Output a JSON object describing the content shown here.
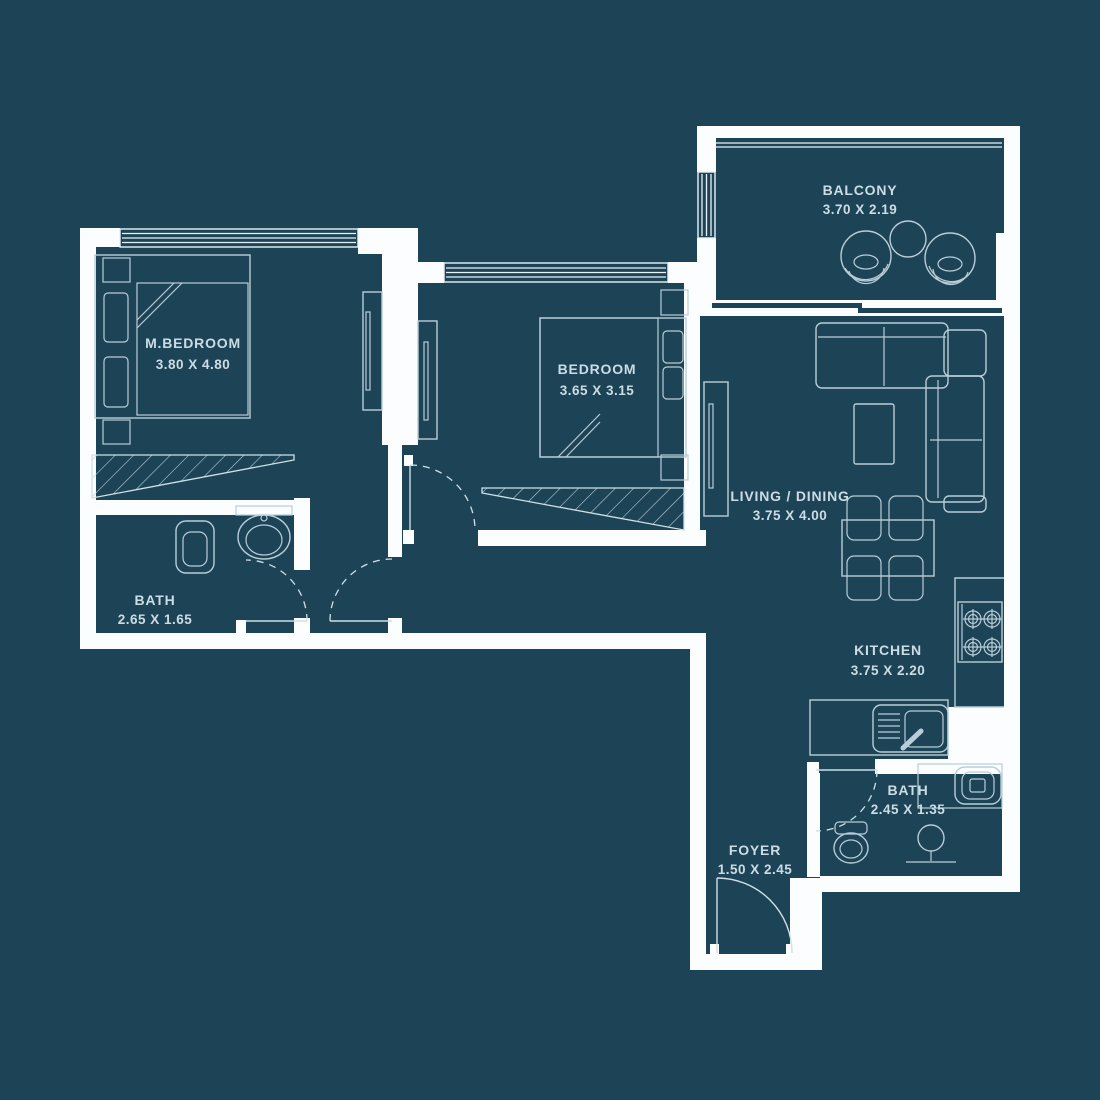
{
  "title": "apartment-floor-plan",
  "colors": {
    "background": "#1d4456",
    "wall": "#fbfdfe",
    "furniture_line": "#b9cdd8",
    "text": "#ccdce5"
  },
  "rooms": {
    "master_bedroom": {
      "name": "M.BEDROOM",
      "dims": "3.80 X 4.80"
    },
    "bedroom": {
      "name": "BEDROOM",
      "dims": "3.65 X 3.15"
    },
    "balcony": {
      "name": "BALCONY",
      "dims": "3.70 X 2.19"
    },
    "living_dining": {
      "name": "LIVING / DINING",
      "dims": "3.75 X 4.00"
    },
    "kitchen": {
      "name": "KITCHEN",
      "dims": "3.75 X 2.20"
    },
    "bath_master": {
      "name": "BATH",
      "dims": "2.65 X 1.65"
    },
    "bath_guest": {
      "name": "BATH",
      "dims": "2.45 X 1.35"
    },
    "foyer": {
      "name": "FOYER",
      "dims": "1.50 X 2.45"
    }
  }
}
